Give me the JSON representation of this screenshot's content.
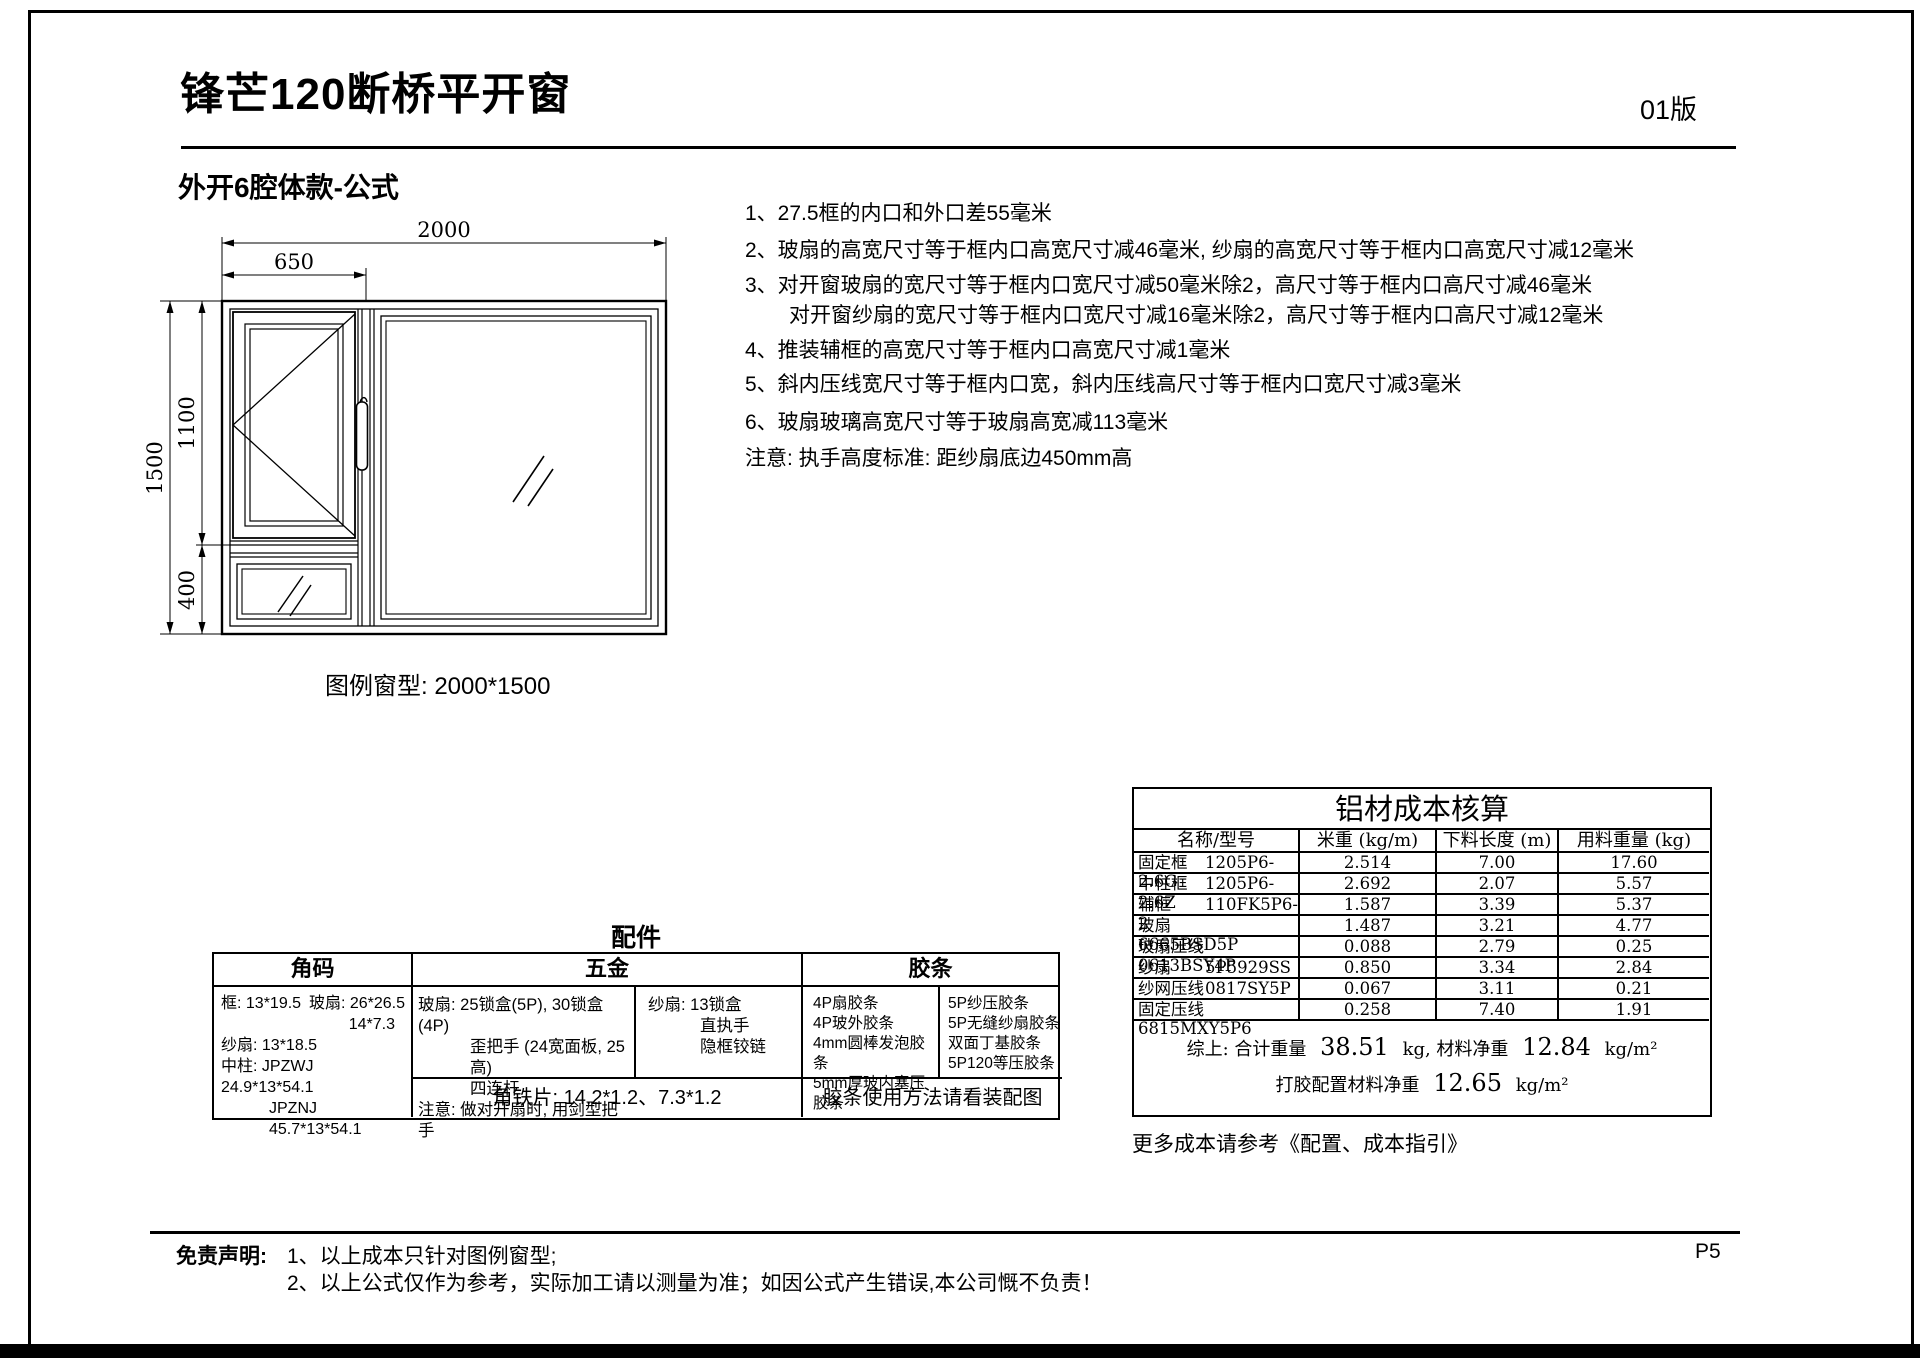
{
  "page": {
    "title": "锋芒120断桥平开窗",
    "version": "01版",
    "subtitle": "外开6腔体款-公式",
    "page_number": "P5"
  },
  "drawing": {
    "dim_total_width": "2000",
    "dim_left_width": "650",
    "dim_total_height": "1500",
    "dim_sash_height": "1100",
    "dim_bottom_height": "400",
    "caption": "图例窗型: 2000*1500"
  },
  "notes": {
    "items": [
      "1、27.5框的内口和外口差55毫米",
      "2、玻扇的高宽尺寸等于框内口高宽尺寸减46毫米, 纱扇的高宽尺寸等于框内口高宽尺寸减12毫米",
      "3、对开窗玻扇的宽尺寸等于框内口宽尺寸减50毫米除2，高尺寸等于框内口高尺寸减46毫米",
      "对开窗纱扇的宽尺寸等于框内口宽尺寸减16毫米除2，高尺寸等于框内口高尺寸减12毫米",
      "4、推装辅框的高宽尺寸等于框内口高宽尺寸减1毫米",
      "5、斜内压线宽尺寸等于框内口宽，斜内压线高尺寸等于框内口宽尺寸减3毫米",
      "6、玻扇玻璃高宽尺寸等于玻扇高宽减113毫米",
      "注意: 执手高度标准: 距纱扇底边450mm高"
    ]
  },
  "accessories": {
    "title": "配件",
    "col_corner": "角码",
    "col_hardware": "五金",
    "col_strip": "胶条",
    "corner_l1a": "框: 13*19.5",
    "corner_l1b": "玻扇: 26*26.5",
    "corner_l2": "14*7.3",
    "corner_l3": "纱扇: 13*18.5",
    "corner_l4": "中柱: JPZWJ 24.9*13*54.1",
    "corner_l5": "JPZNJ 45.7*13*54.1",
    "hw_l1": "玻扇:  25锁盒(5P), 30锁盒 (4P)",
    "hw_l2": "歪把手 (24宽面板, 25高)",
    "hw_l3": "四连杆",
    "hw_l4": "注意: 做对开扇时, 用剑型把手",
    "hw_r1": "纱扇: 13锁盒",
    "hw_r2": "直执手",
    "hw_r3": "隐框铰链",
    "strip_l": [
      "4P扇胶条",
      "4P玻外胶条",
      "4mm圆棒发泡胶条",
      "5mm厚玻内塞压胶条"
    ],
    "strip_r": [
      "5P纱压胶条",
      "5P无缝纱扇胶条",
      "双面丁基胶条",
      "5P120等压胶条"
    ],
    "hw_footer": "角铁片: 14.2*1.2、7.3*1.2",
    "strip_footer": "胶条使用方法请看装配图"
  },
  "cost_table": {
    "title": "铝材成本核算",
    "headers": [
      "名称/型号",
      "米重 (kg/m)",
      "下料长度 (m)",
      "用料重量 (kg)"
    ],
    "rows": [
      {
        "name": "固定框",
        "model": "1205P6-2.6G",
        "meter_weight": "2.514",
        "cut_length": "7.00",
        "material_weight": "17.60"
      },
      {
        "name": "中柱框",
        "model": "1205P6-2.6Z",
        "meter_weight": "2.692",
        "cut_length": "2.07",
        "material_weight": "5.57"
      },
      {
        "name": "辅框",
        "model": "110FK5P6-2",
        "meter_weight": "1.587",
        "cut_length": "3.39",
        "material_weight": "5.37"
      },
      {
        "name": "玻扇",
        "model": "6665BSD5P",
        "meter_weight": "1.487",
        "cut_length": "3.21",
        "material_weight": "4.77"
      },
      {
        "name": "玻扇压线",
        "model": "0613BSY4P",
        "meter_weight": "0.088",
        "cut_length": "2.79",
        "material_weight": "0.25"
      },
      {
        "name": "纱扇",
        "model": "5P5929SS",
        "meter_weight": "0.850",
        "cut_length": "3.34",
        "material_weight": "2.84"
      },
      {
        "name": "纱网压线",
        "model": "0817SY5P",
        "meter_weight": "0.067",
        "cut_length": "3.11",
        "material_weight": "0.21"
      },
      {
        "name": "固定压线",
        "model": "6815MXY5P6",
        "meter_weight": "0.258",
        "cut_length": "7.40",
        "material_weight": "1.91"
      }
    ],
    "summary_prefix": "综上: 合计重量",
    "summary_total": "38.51",
    "summary_mid": "kg, 材料净重",
    "summary_net": "12.84",
    "summary_unit": "kg/m²",
    "summary2_prefix": "打胶配置材料净重",
    "summary2_value": "12.65",
    "summary2_unit": "kg/m²",
    "note": "更多成本请参考《配置、成本指引》"
  },
  "footer": {
    "label": "免责声明:",
    "line1": "1、以上成本只针对图例窗型;",
    "line2": "2、以上公式仅作为参考，实际加工请以测量为准；如因公式产生错误,本公司慨不负责！"
  }
}
